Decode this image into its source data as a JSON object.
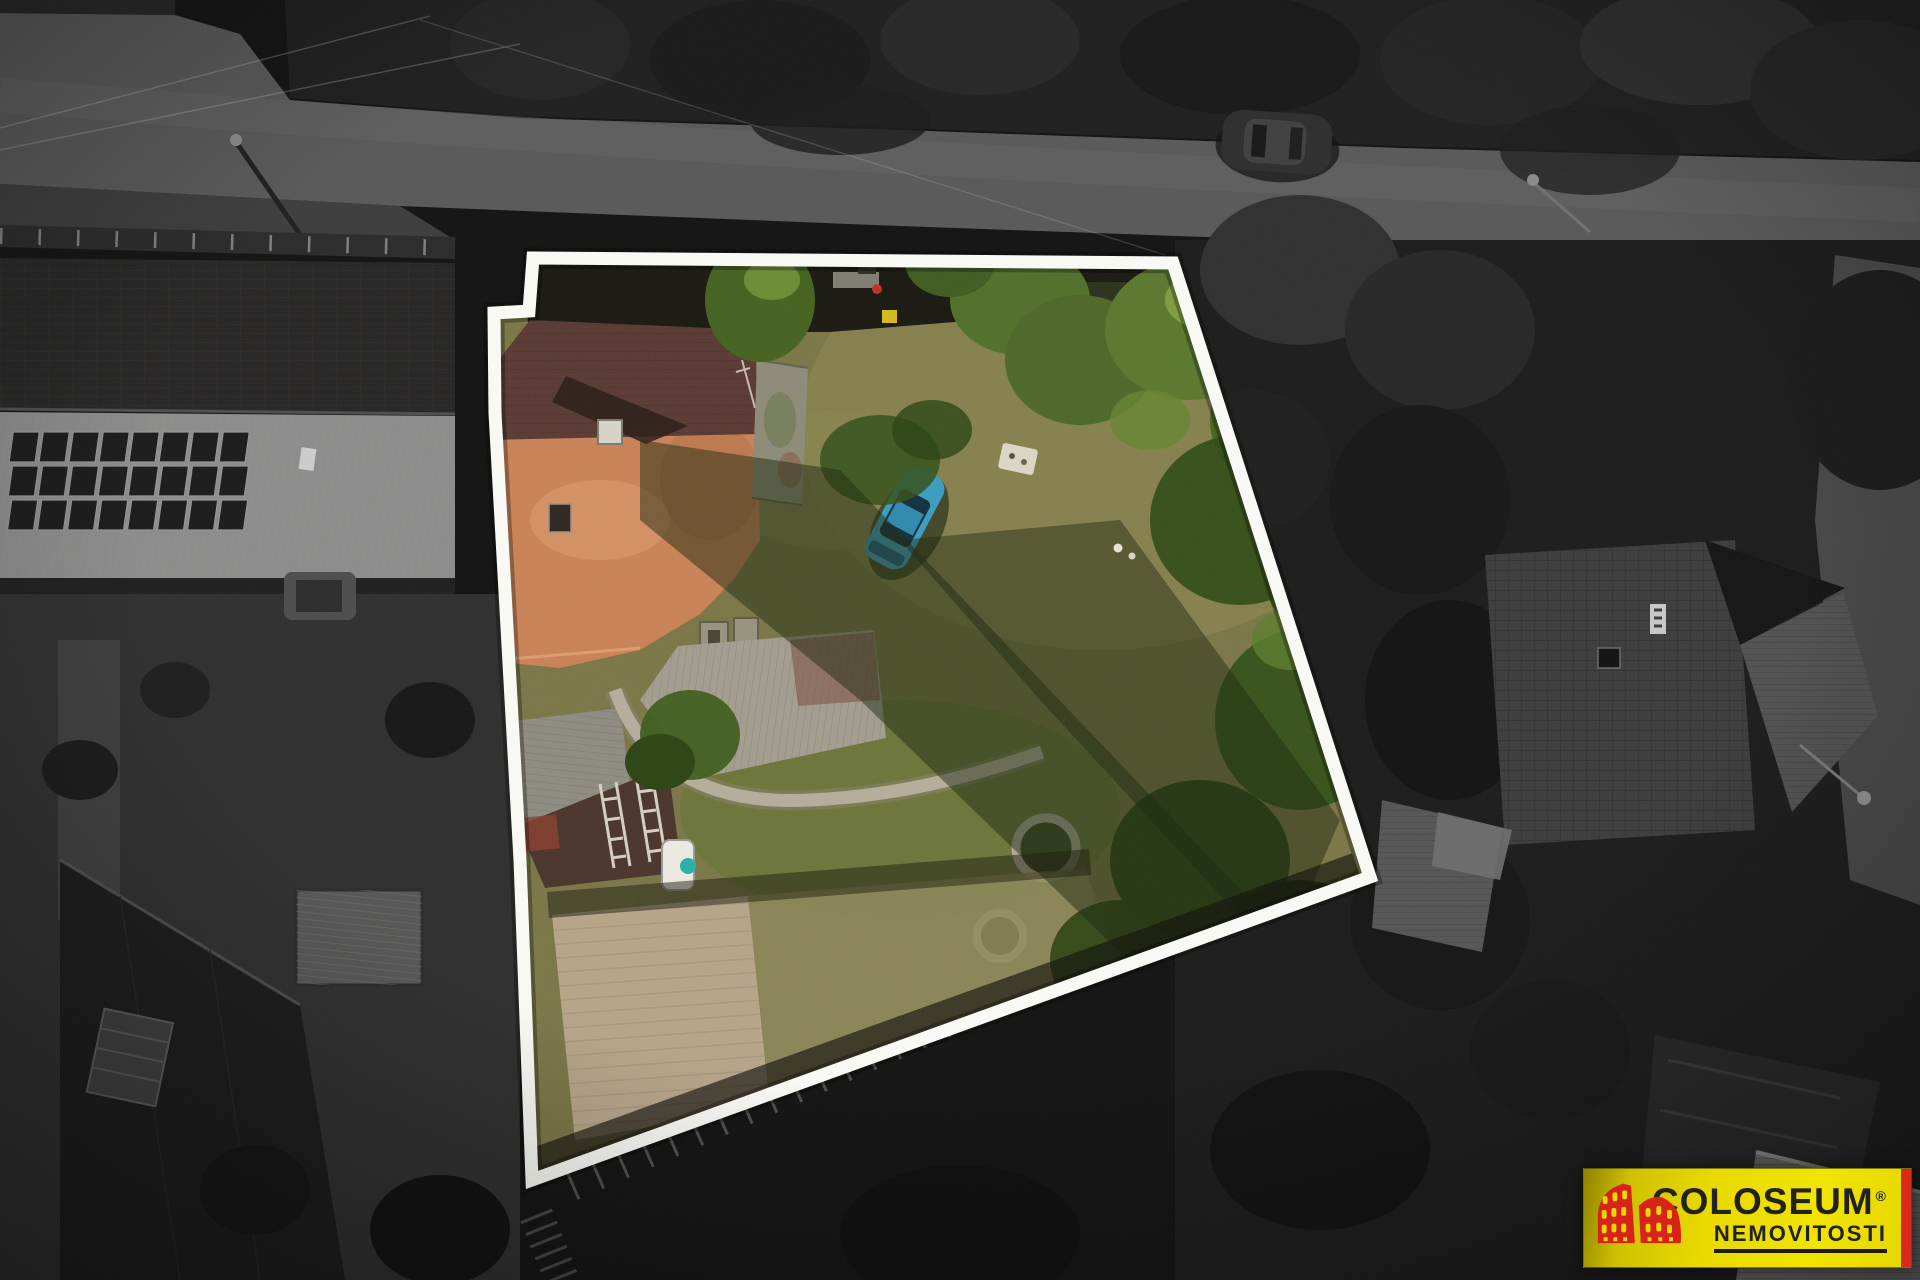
{
  "scene": {
    "kind": "aerial-drone-photo",
    "description": "Top-down drone photo of a village plot; surroundings are desaturated dark grayscale, the offered property is shown in color and traced with a thick white boundary.",
    "property_outline": {
      "color": "#fafaf6",
      "points": "533,258 1173,263 1370,877 532,1180 520,860 495,413 494,313 529,311"
    },
    "colors": {
      "backdrop": "#121212",
      "road": "#585858",
      "lawn": "#7a7646",
      "roof_orange": "#ca8256",
      "roof_dark_brown": "#5a3a33",
      "flat_annex_roof": "#8d8a78",
      "corrugated_roof": "#a39d90",
      "car_blue": "#3c9cc0",
      "bare_soil": "#b7a489",
      "stone_path": "#b8b09e"
    },
    "features": {
      "road": "asphalt street along the top",
      "parked_car_street": "dark car on the street",
      "solar_building": "long barn with rooftop solar array, left side",
      "neighbor_house": "large hip-roof house, right side",
      "highlight_house": "farmhouse with two-tone orange/brown tiled roof",
      "garden_car": "blue car parked on the lawn",
      "garden": "lawn, fruit trees, stone path, round stone beds, tilled soil patch"
    }
  },
  "watermark": {
    "brand": "COLOSEUM",
    "registered": "®",
    "subtitle": "NEMOVITOSTI",
    "colors": {
      "background": "#e9d900",
      "stripe": "#d9291b",
      "icon": "#d8231a",
      "text": "#23221a"
    }
  }
}
